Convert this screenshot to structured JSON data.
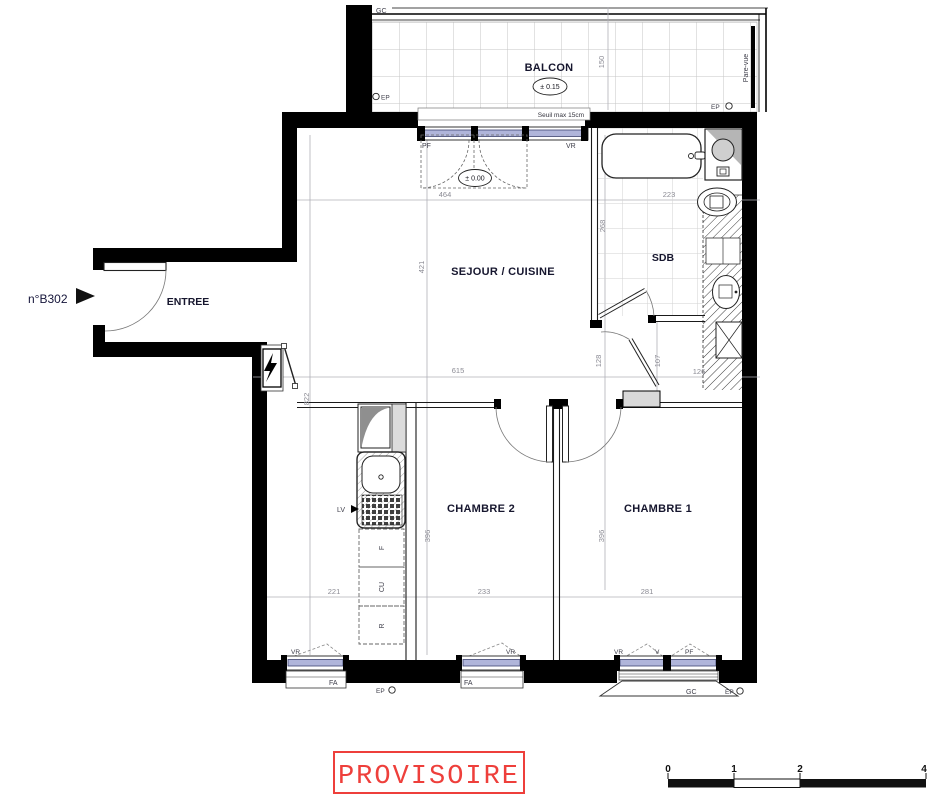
{
  "plan": {
    "unit_number": "n°B302",
    "rooms": {
      "balcon": "BALCON",
      "sejour": "SEJOUR / CUISINE",
      "sdb": "SDB",
      "entree": "ENTREE",
      "chambre2": "CHAMBRE 2",
      "chambre1": "CHAMBRE 1"
    },
    "levels": {
      "balcon": "± 0.15",
      "sejour": "± 0.00"
    },
    "notes": {
      "seuil": "Seuil max 15cm",
      "pare_vue": "Pare-vue"
    },
    "tags": {
      "gc": "GC",
      "ep": "EP",
      "pf": "PF",
      "vr": "VR",
      "fa": "FA",
      "v": "V",
      "lv": "LV",
      "f": "F",
      "cu": "CU",
      "r": "R"
    },
    "dims": {
      "balcon_depth": "150",
      "sejour_width": "464",
      "sdb_width": "223",
      "sdb_depth": "268",
      "sejour_depth": "421",
      "sejour_total_width": "615",
      "hall_left": "128",
      "hall_right": "107",
      "duct_width": "126",
      "apartment_depth": "822",
      "chambre2_depth": "396",
      "chambre1_depth": "396",
      "kitchen_width": "221",
      "chambre2_width": "233",
      "chambre1_width": "281"
    },
    "stamp": "PROVISOIRE",
    "scale_bar": {
      "t0": "0",
      "t1": "1",
      "t2": "2",
      "t4": "4"
    },
    "colors": {
      "glazing": "#b0b5da",
      "stamp_red": "#ee3f3b",
      "wall": "#000000",
      "dim_text": "#8b8b94"
    }
  }
}
